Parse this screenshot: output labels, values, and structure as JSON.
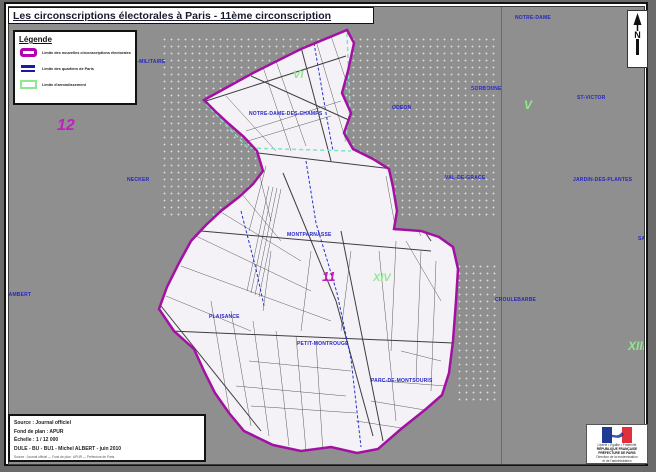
{
  "title": "Les circonscriptions électorales à Paris - 11ème circonscription",
  "legend": {
    "title": "Légende",
    "items": [
      {
        "label": "Limite des nouvelles circonscriptions électorales",
        "color": "#b400b4",
        "swatch": "magenta-rounded-rect"
      },
      {
        "label": "Limite des quartiers de Paris",
        "color": "#1a1aa6",
        "swatch": "blue-dashes"
      },
      {
        "label": "Limite d'arrondissement",
        "color": "#8ee88e",
        "swatch": "green-rect"
      }
    ]
  },
  "compass": {
    "label": "N"
  },
  "map": {
    "circonscription_numbers": [
      {
        "text": "12"
      },
      {
        "text": "11"
      }
    ],
    "arrondissement_numerals": [
      {
        "text": "VI"
      },
      {
        "text": "V"
      },
      {
        "text": "XIV"
      },
      {
        "text": "XIII"
      }
    ],
    "quartier_labels": [
      {
        "text": "NOTRE-DAME-DES-CHAMPS"
      },
      {
        "text": "MONTPARNASSE"
      },
      {
        "text": "PLAISANCE"
      },
      {
        "text": "PETIT-MONTROUGE"
      },
      {
        "text": "PARC-DE-MONTSOURIS"
      },
      {
        "text": "NOTRE-DAME"
      },
      {
        "text": "SORBONNE"
      },
      {
        "text": "ST-VICTOR"
      },
      {
        "text": "ODEON"
      },
      {
        "text": "VAL-DE-GRACE"
      },
      {
        "text": "JARDIN-DES-PLANTES"
      },
      {
        "text": "NECKER"
      },
      {
        "text": "CROULEBARBE"
      },
      {
        "text": "ECOLE-MILITAIRE"
      },
      {
        "text": "ST-LAMBERT"
      },
      {
        "text": "SALPETRIERE"
      }
    ],
    "colors": {
      "circonscription_boundary": "#a310a3",
      "quartier_boundary": "#2233cc",
      "arrondissement_boundary": "#7de4c3",
      "district_fill": "#f4f2f6",
      "background": "#8f8f8f"
    }
  },
  "source_box": {
    "lines": [
      "Source : Journal officiel",
      "Fond de plan : APUR",
      "Échelle : 1 / 12 000",
      "DULE - BU - BU1 - Michel ALBERT - juin 2010"
    ],
    "fine_print": "Source : Journal officiel — Fond de plan : APUR — Préfecture de Paris"
  },
  "agency_box": {
    "motto": "Liberté • Égalité • Fraternité",
    "republic": "RÉPUBLIQUE FRANÇAISE",
    "prefecture": "PRÉFECTURE DE PARIS",
    "direction_line1": "Direction de la modernisation",
    "direction_line2": "et de l'administration"
  }
}
